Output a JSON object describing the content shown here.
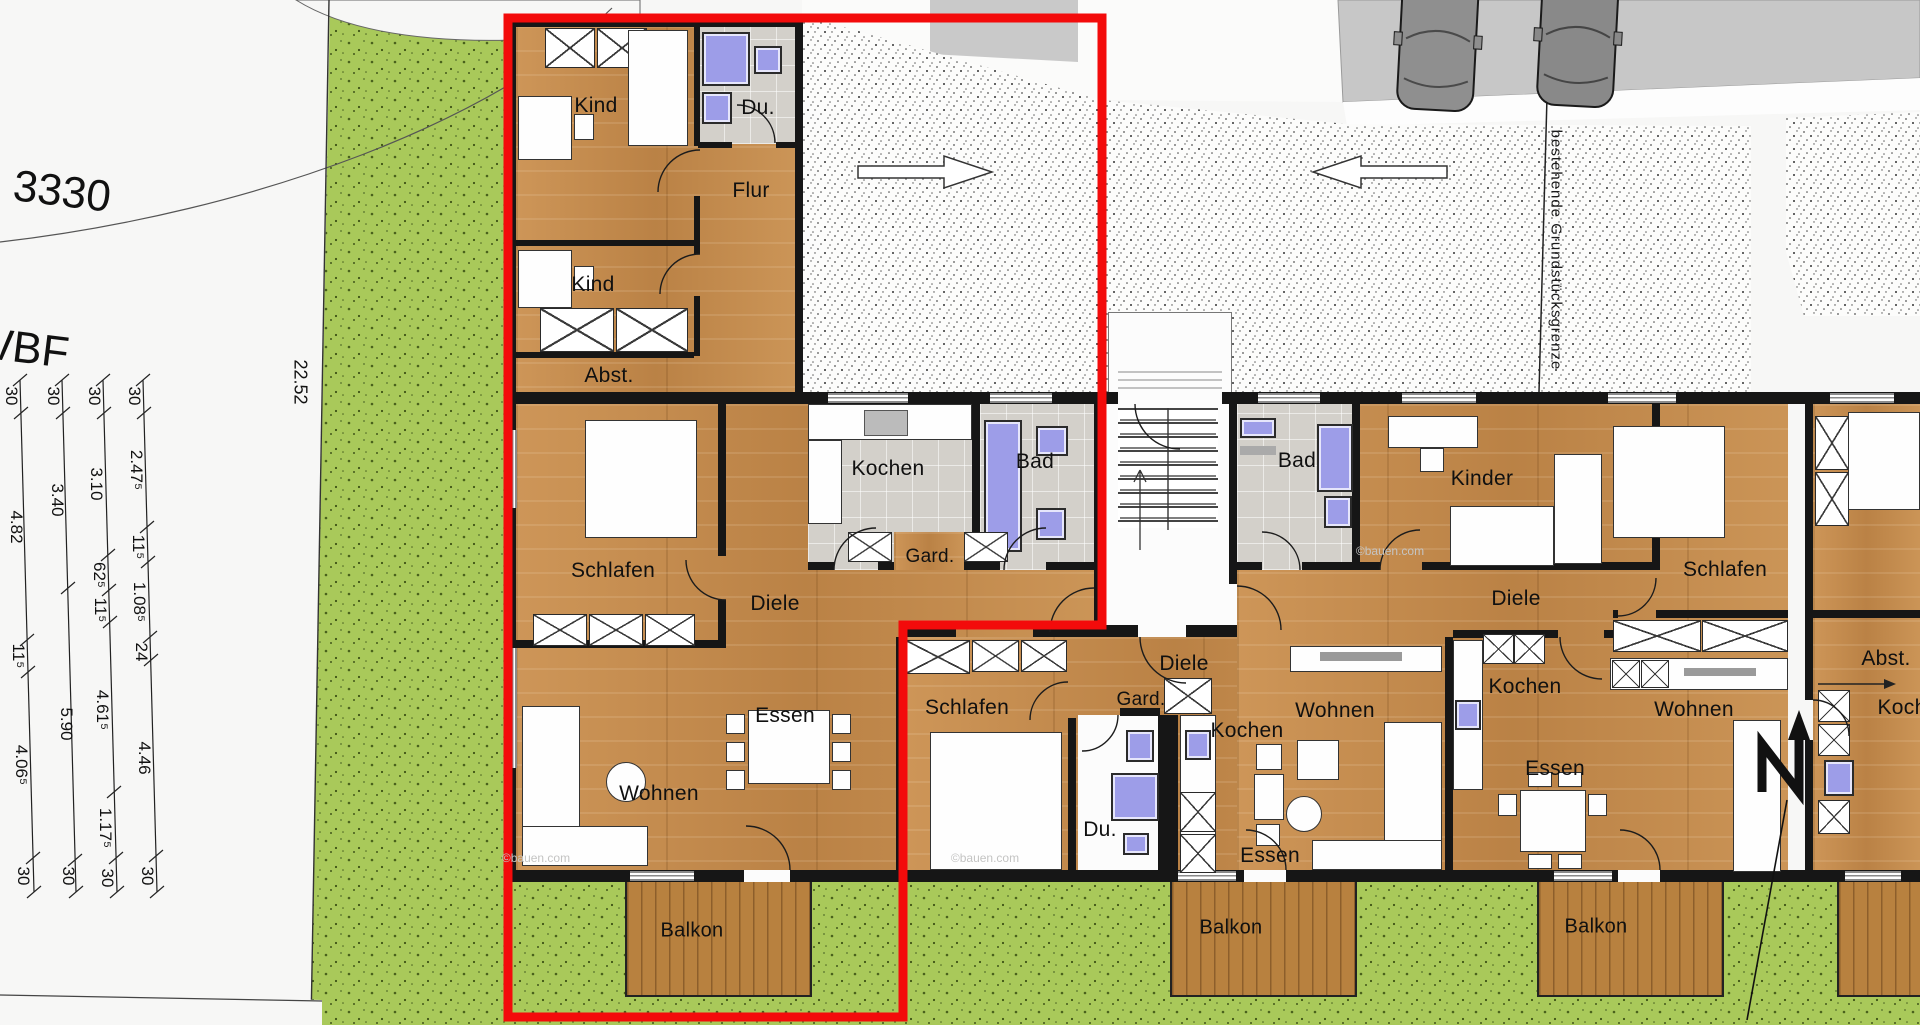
{
  "site": {
    "parcel_number": "3330",
    "area_label": "WBF",
    "boundary_length_m": "22.52",
    "boundary_name": "bestehende Grundstücksgrenze",
    "watermark": "©bauen.com"
  },
  "colors": {
    "highlight_outline": "#f30b0b",
    "grass": "#a9c95a",
    "wood_floor": "#c48c4e",
    "tile_floor": "#d3d0ca",
    "sanitary_blue": "#9d9de8",
    "wall": "#161616"
  },
  "dimension_chains": {
    "chain_1": [
      "30",
      "4.82",
      "11⁵",
      "4.06⁵",
      "30"
    ],
    "chain_2": [
      "30",
      "3.40",
      "5.90",
      "30"
    ],
    "chain_3": [
      "30",
      "3.10",
      "62⁵",
      "11⁵",
      "4.61⁵",
      "1.17⁵",
      "30"
    ],
    "chain_4": [
      "30",
      "2.47⁵",
      "11⁵",
      "1.08⁵",
      "24",
      "4.46",
      "30"
    ]
  },
  "apartment_highlighted": {
    "kind_1": "Kind",
    "du": "Du.",
    "flur": "Flur",
    "kind_2": "Kind",
    "abst": "Abst.",
    "schlafen": "Schlafen",
    "kochen": "Kochen",
    "bad": "Bad",
    "gard": "Gard.",
    "diele": "Diele",
    "essen": "Essen",
    "wohnen": "Wohnen",
    "balkon": "Balkon"
  },
  "apartment_middle": {
    "schlafen": "Schlafen",
    "diele": "Diele",
    "gard": "Gard.",
    "du": "Du.",
    "kochen": "Kochen",
    "wohnen": "Wohnen",
    "essen": "Essen",
    "balkon": "Balkon"
  },
  "apartment_right": {
    "bad": "Bad",
    "kinder": "Kinder",
    "schlafen": "Schlafen",
    "diele": "Diele",
    "kochen": "Kochen",
    "wohnen": "Wohnen",
    "essen": "Essen",
    "balkon": "Balkon"
  },
  "apartment_far_right": {
    "abst": "Abst.",
    "kochen": "Kochen"
  }
}
